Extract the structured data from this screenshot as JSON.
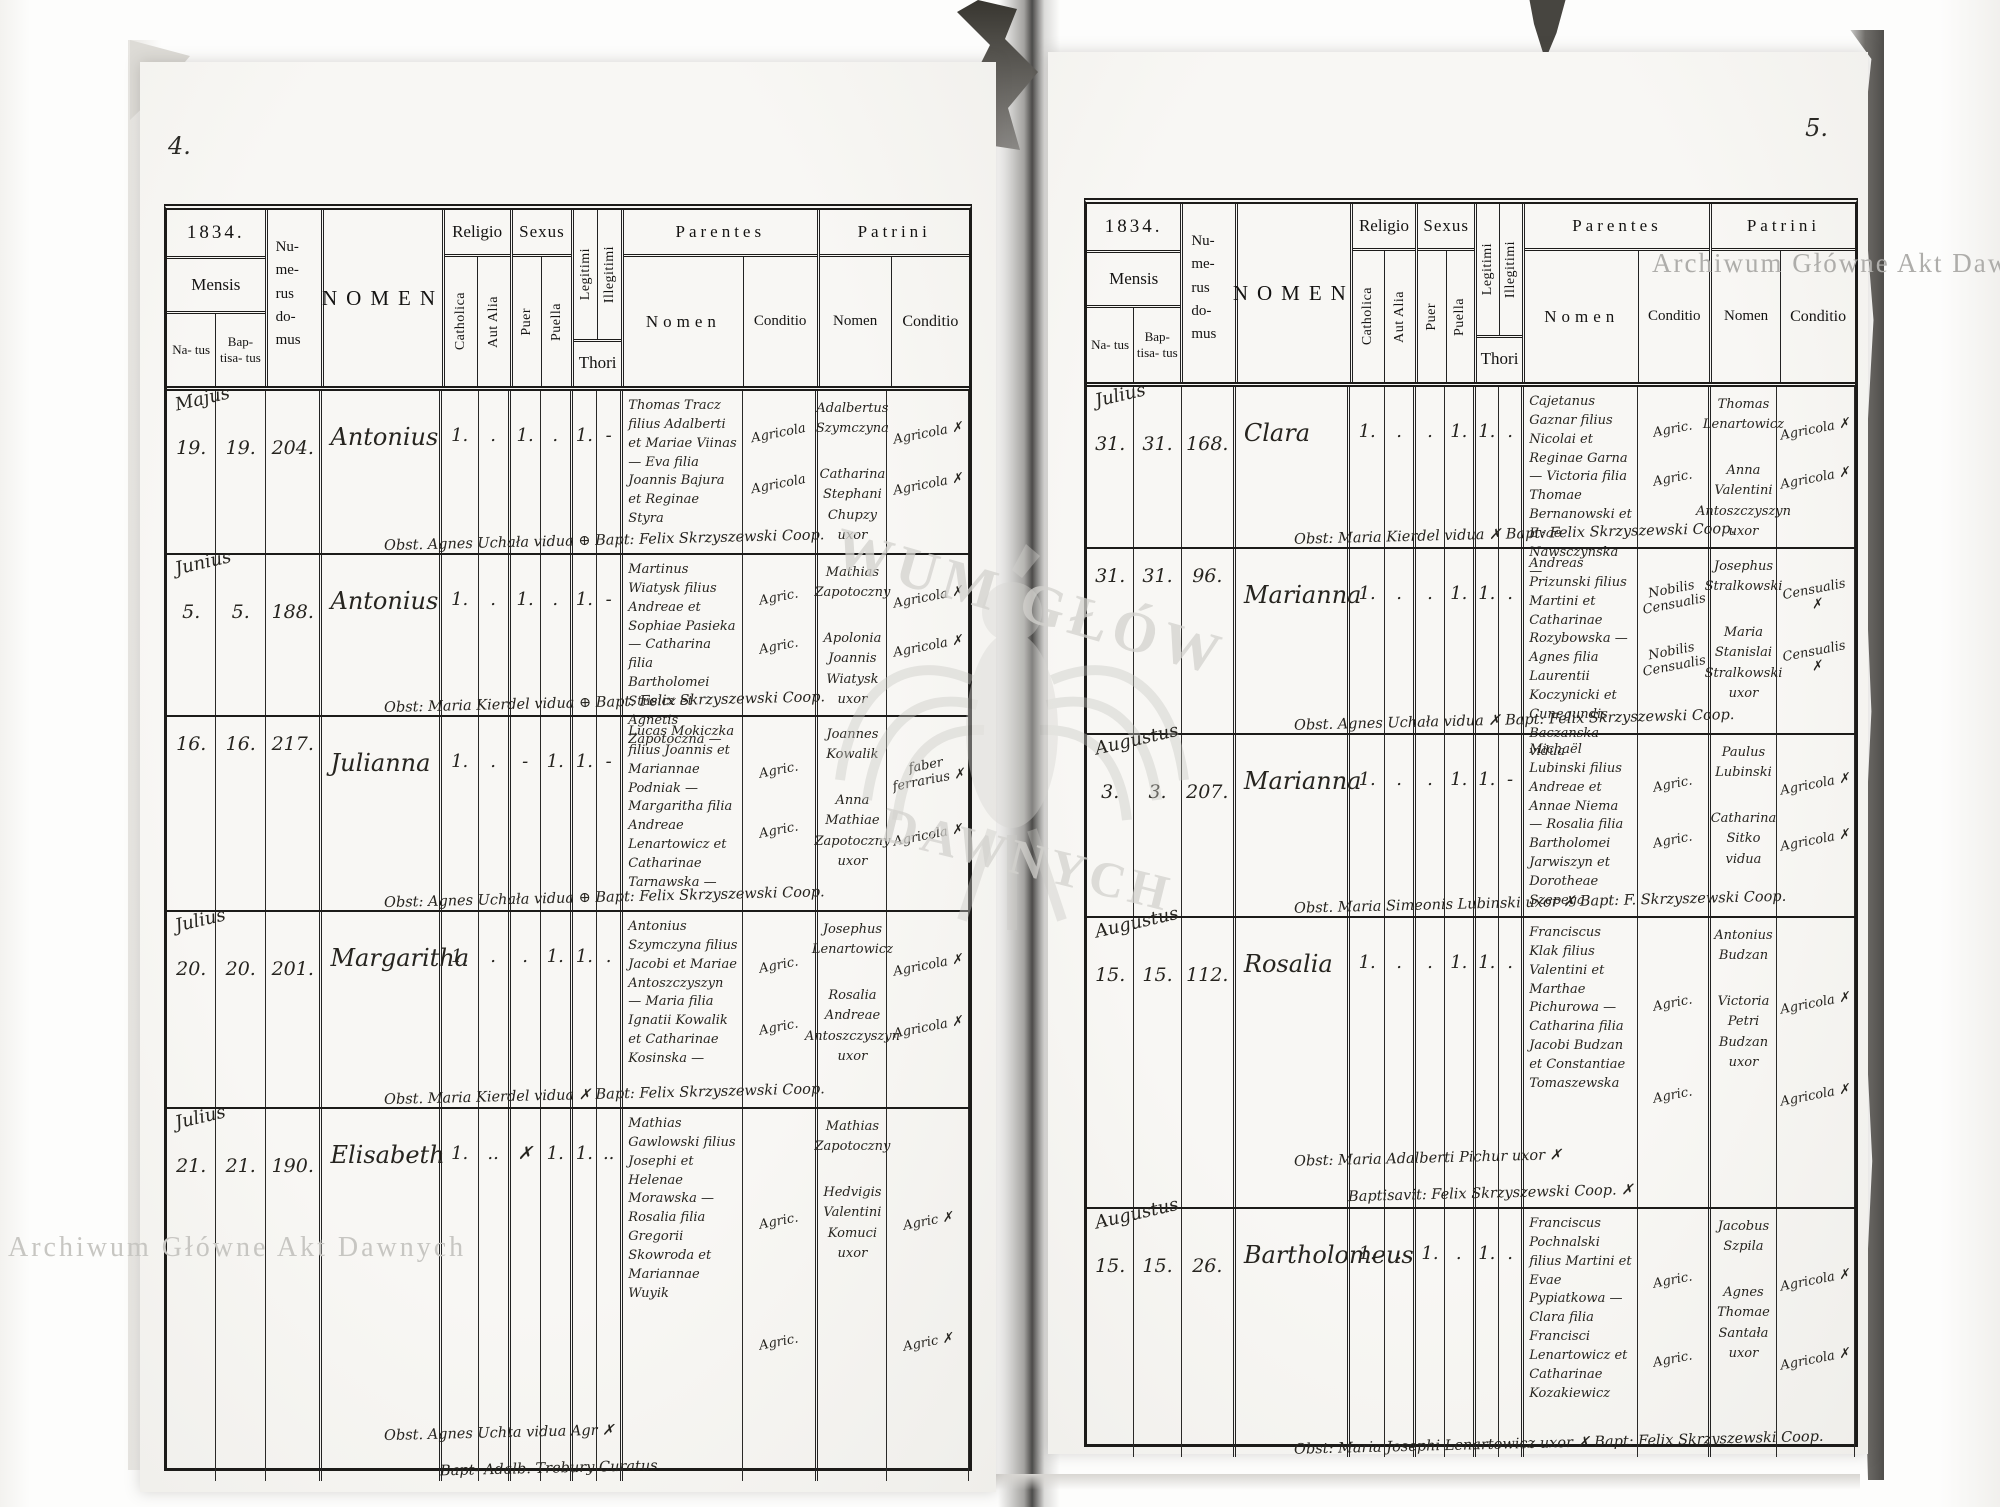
{
  "watermark": {
    "text": "Archiwum Główne Akt Dawnych",
    "center_fragment_top": "WUM GŁÓW",
    "center_fragment_bottom": "DAWNYCH"
  },
  "header": {
    "mensis": "Mensis",
    "natus": "Na- tus",
    "baptisatus": "Bap- tisa- tus",
    "numerus_domus": "Nu- me- rus do- mus",
    "nomen": "NOMEN",
    "religio": "Religio",
    "catholica": "Catholica",
    "aut_alia": "Aut Alia",
    "sexus": "Sexus",
    "puer": "Puer",
    "puella": "Puella",
    "legitimi": "Legitimi",
    "illegitimi": "Illegitimi",
    "thori": "Thori",
    "parentes": "Parentes",
    "patrini": "Patrini",
    "nomen_sub": "Nomen",
    "conditio": "Conditio"
  },
  "pages": [
    {
      "page_number": "4.",
      "year": "1834.",
      "records": [
        {
          "month": "Majus",
          "natus": "19.",
          "baptisatus": "19.",
          "numerus_domus": "204.",
          "nomen": "Antonius",
          "catholica": "1.",
          "aut_alia": ".",
          "puer": "1.",
          "puella": ".",
          "legitimi": "1.",
          "illegitimi": "-",
          "parentes_nomen": "Thomas Tracz filius Adalberti et Mariae Viinas — Eva filia Joannis Bajura et Reginae Styra",
          "parentes_conditio": [
            "Agricola",
            "Agricola"
          ],
          "patrini_nomen": [
            "Adalbertus Szymczyna",
            "Catharina Stephani Chupzy uxor"
          ],
          "patrini_conditio": [
            "Agricola ✗",
            "Agricola ✗"
          ],
          "footer": "Obst. Agnes Uchała vidua ⊕ Bapt: Felix Skrzyszewski Coop.",
          "footer2": ""
        },
        {
          "month": "Junius",
          "natus": "5.",
          "baptisatus": "5.",
          "numerus_domus": "188.",
          "nomen": "Antonius",
          "catholica": "1.",
          "aut_alia": ".",
          "puer": "1.",
          "puella": ".",
          "legitimi": "1.",
          "illegitimi": "-",
          "parentes_nomen": "Martinus Wiatysk filius Andreae et Sophiae Pasieka — Catharina filia Bartholomei Stusicz et Agnetis Zapotoczna —",
          "parentes_conditio": [
            "Agric.",
            "Agric."
          ],
          "patrini_nomen": [
            "Mathias Zapotoczny",
            "Apolonia Joannis Wiatysk uxor"
          ],
          "patrini_conditio": [
            "Agricola ✗",
            "Agricola ✗"
          ],
          "footer": "Obst: Maria Kierdel vidua ⊕ Bapt: Felix Skrzyszewski Coop.",
          "footer2": ""
        },
        {
          "month": "",
          "natus": "16.",
          "baptisatus": "16.",
          "numerus_domus": "217.",
          "nomen": "Julianna",
          "catholica": "1.",
          "aut_alia": ".",
          "puer": "-",
          "puella": "1.",
          "legitimi": "1.",
          "illegitimi": "-",
          "parentes_nomen": "Lucas Mokiczka filius Joannis et Mariannae Podniak — Margaritha filia Andreae Lenartowicz et Catharinae Tarnawska —",
          "parentes_conditio": [
            "Agric.",
            "Agric."
          ],
          "patrini_nomen": [
            "Joannes Kowalik",
            "Anna Mathiae Zapotoczny uxor"
          ],
          "patrini_conditio": [
            "faber ferrarius ✗",
            "Agricola ✗"
          ],
          "footer": "Obst: Agnes Uchała vidua ⊕ Bapt: Felix Skrzyszewski Coop.",
          "footer2": ""
        },
        {
          "month": "Julius",
          "natus": "20.",
          "baptisatus": "20.",
          "numerus_domus": "201.",
          "nomen": "Margaritha",
          "catholica": "1.",
          "aut_alia": ".",
          "puer": ".",
          "puella": "1.",
          "legitimi": "1.",
          "illegitimi": ".",
          "parentes_nomen": "Antonius Szymczyna filius Jacobi et Mariae Antoszczyszyn — Maria filia Ignatii Kowalik et Catharinae Kosinska —",
          "parentes_conditio": [
            "Agric.",
            "Agric."
          ],
          "patrini_nomen": [
            "Josephus Lenartowicz",
            "Rosalia Andreae Antoszczyszyn uxor"
          ],
          "patrini_conditio": [
            "Agricola ✗",
            "Agricola ✗"
          ],
          "footer": "Obst. Maria Kierdel vidua ✗ Bapt: Felix Skrzyszewski Coop.",
          "footer2": ""
        },
        {
          "month": "Julius",
          "natus": "21.",
          "baptisatus": "21.",
          "numerus_domus": "190.",
          "nomen": "Elisabeth",
          "catholica": "1.",
          "aut_alia": "..",
          "puer": "✗",
          "puella": "1.",
          "legitimi": "1.",
          "illegitimi": "..",
          "parentes_nomen": "Mathias Gawlowski filius Josephi et Helenae Morawska — Rosalia filia Gregorii Skowroda et Mariannae Wuyik",
          "parentes_conditio": [
            "Agric.",
            "Agric."
          ],
          "patrini_nomen": [
            "Mathias Zapotoczny",
            "Hedvigis Valentini Komuci uxor"
          ],
          "patrini_conditio": [
            "Agric ✗",
            "Agric ✗"
          ],
          "footer": "Obst. Agnes Uchta vidua Agr ✗",
          "footer2": "Bapt- Adalb. Trebury Curatus"
        }
      ]
    },
    {
      "page_number": "5.",
      "year": "1834.",
      "records": [
        {
          "month": "Julius",
          "natus": "31.",
          "baptisatus": "31.",
          "numerus_domus": "168.",
          "nomen": "Clara",
          "catholica": "1.",
          "aut_alia": ".",
          "puer": ".",
          "puella": "1.",
          "legitimi": "1.",
          "illegitimi": ".",
          "parentes_nomen": "Cajetanus Gaznar filius Nicolai et Reginae Garna — Victoria filia Thomae Bernanowski et Evae Nawsczynska —",
          "parentes_conditio": [
            "Agric.",
            "Agric."
          ],
          "patrini_nomen": [
            "Thomas Lenartowicz",
            "Anna Valentini Antoszczyszyn uxor"
          ],
          "patrini_conditio": [
            "Agricola ✗",
            "Agricola ✗"
          ],
          "footer": "Obst: Maria Kierdel vidua ✗ Bapt: Felix Skrzyszewski Coop.",
          "footer2": ""
        },
        {
          "month": "",
          "natus": "31.",
          "baptisatus": "31.",
          "numerus_domus": "96.",
          "nomen": "Marianna",
          "catholica": "1.",
          "aut_alia": ".",
          "puer": ".",
          "puella": "1.",
          "legitimi": "1.",
          "illegitimi": ".",
          "parentes_nomen": "Andreas Prizunski filius Martini et Catharinae Rozybowska — Agnes filia Laurentii Koczynicki et Cunegundis Baczanska — vidua",
          "parentes_conditio": [
            "Nobilis Censualis",
            "Nobilis Censualis"
          ],
          "patrini_nomen": [
            "Josephus Stralkowski",
            "Maria Stanislai Stralkowski uxor"
          ],
          "patrini_conditio": [
            "Censualis ✗",
            "Censualis ✗"
          ],
          "footer": "Obst. Agnes Uchała vidua ✗ Bapt: Felix Skrzyszewski Coop.",
          "footer2": ""
        },
        {
          "month": "Augustus",
          "natus": "3.",
          "baptisatus": "3.",
          "numerus_domus": "207.",
          "nomen": "Marianna",
          "catholica": "1.",
          "aut_alia": ".",
          "puer": ".",
          "puella": "1.",
          "legitimi": "1.",
          "illegitimi": "-",
          "parentes_nomen": "Michaël Lubinski filius Andreae et Annae Niema — Rosalia filia Bartholomei Jarwiszyn et Dorotheae Szepega",
          "parentes_conditio": [
            "Agric.",
            "Agric."
          ],
          "patrini_nomen": [
            "Paulus Lubinski",
            "Catharina Sitko vidua"
          ],
          "patrini_conditio": [
            "Agricola ✗",
            "Agricola ✗"
          ],
          "footer": "Obst. Maria Simeonis Lubinski uxor ✗ Bapt: F. Skrzyszewski Coop.",
          "footer2": ""
        },
        {
          "month": "Augustus",
          "natus": "15.",
          "baptisatus": "15.",
          "numerus_domus": "112.",
          "nomen": "Rosalia",
          "catholica": "1.",
          "aut_alia": ".",
          "puer": ".",
          "puella": "1.",
          "legitimi": "1.",
          "illegitimi": ".",
          "parentes_nomen": "Franciscus Klak filius Valentini et Marthae Pichurowa — Catharina filia Jacobi Budzan et Constantiae Tomaszewska",
          "parentes_conditio": [
            "Agric.",
            "Agric."
          ],
          "patrini_nomen": [
            "Antonius Budzan",
            "Victoria Petri Budzan uxor"
          ],
          "patrini_conditio": [
            "Agricola ✗",
            "Agricola ✗"
          ],
          "footer": "Obst: Maria Adalberti Pichur uxor ✗",
          "footer2": "Baptisavit: Felix Skrzyszewski Coop. ✗"
        },
        {
          "month": "Augustus",
          "natus": "15.",
          "baptisatus": "15.",
          "numerus_domus": "26.",
          "nomen": "Bartholomeus",
          "catholica": "1.",
          "aut_alia": ".",
          "puer": "1.",
          "puella": ".",
          "legitimi": "1.",
          "illegitimi": ".",
          "parentes_nomen": "Franciscus Pochnalski filius Martini et Evae Pypiatkowa — Clara filia Francisci Lenartowicz et Catharinae Kozakiewicz",
          "parentes_conditio": [
            "Agric.",
            "Agric."
          ],
          "patrini_nomen": [
            "Jacobus Szpila",
            "Agnes Thomae Santała uxor"
          ],
          "patrini_conditio": [
            "Agricola ✗",
            "Agricola ✗"
          ],
          "footer": "Obst: Maria Josephi Lenartowicz uxor ✗ Bapt: Felix Skrzyszewski Coop.",
          "footer2": ""
        }
      ]
    }
  ]
}
